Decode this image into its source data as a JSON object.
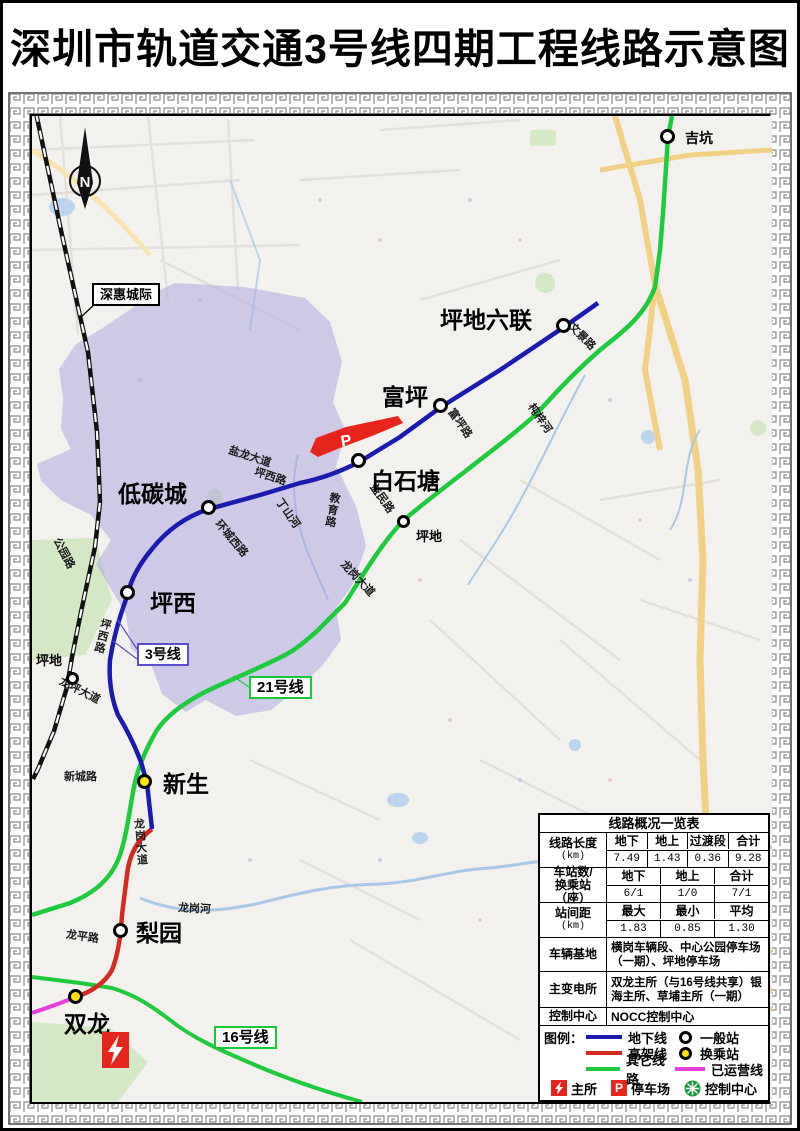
{
  "title": "深圳市轨道交通3号线四期工程线路示意图",
  "compass_label": "N",
  "map": {
    "stations": [
      {
        "name": "吉坑",
        "type": "normal"
      },
      {
        "name": "坪地六联",
        "type": "normal"
      },
      {
        "name": "富坪",
        "type": "normal"
      },
      {
        "name": "白石塘",
        "type": "normal"
      },
      {
        "name": "低碳城",
        "type": "normal"
      },
      {
        "name": "坪西",
        "type": "normal"
      },
      {
        "name": "新生",
        "type": "transfer"
      },
      {
        "name": "梨园",
        "type": "normal"
      },
      {
        "name": "双龙",
        "type": "transfer"
      },
      {
        "name": "坪地",
        "type": "railway"
      },
      {
        "name": "坪地",
        "type": "other-line"
      }
    ],
    "callouts": {
      "shenhui": "深惠城际",
      "line3": "3号线",
      "line21": "21号线",
      "line16": "16号线"
    },
    "roads": [
      "文景路",
      "富坪路",
      "杶梓河",
      "益民路",
      "教育路",
      "丁山河",
      "环城西路",
      "坪西路",
      "盐龙大道",
      "公园路",
      "坪西路",
      "龙坪大道",
      "新城路",
      "龙岗大道",
      "龙岗大道",
      "龙平路",
      "龙岗河"
    ],
    "parking_label": "P"
  },
  "table": {
    "title": "线路概况一览表",
    "length": {
      "label": "线路长度",
      "unit": "(km)",
      "headers": [
        "地下",
        "地上",
        "过渡段",
        "合计"
      ],
      "values": [
        "7.49",
        "1.43",
        "0.36",
        "9.28"
      ]
    },
    "stations": {
      "label": "车站数/",
      "label2": "换乘站（座）",
      "headers": [
        "地下",
        "地上",
        "合计"
      ],
      "values": [
        "6/1",
        "1/0",
        "7/1"
      ]
    },
    "spacing": {
      "label": "站间距",
      "unit": "(km)",
      "headers": [
        "最大",
        "最小",
        "平均"
      ],
      "values": [
        "1.83",
        "0.85",
        "1.30"
      ]
    },
    "depot": {
      "label": "车辆基地",
      "value": "横岗车辆段、中心公园停车场（一期）、坪地停车场"
    },
    "substation": {
      "label": "主变电所",
      "value": "双龙主所（与16号线共享）银海主所、草埔主所（一期）"
    },
    "control": {
      "label": "控制中心",
      "value": "NOCC控制中心"
    }
  },
  "legend": {
    "label": "图例：",
    "underground": "地下线",
    "elevated": "高架线",
    "other": "其它线路",
    "normal_station": "一般站",
    "transfer_station": "换乘站",
    "operating": "已运营线",
    "substation": "主所",
    "parking": "停车场",
    "control_center": "控制中心"
  },
  "colors": {
    "underground": "#1b1bb0",
    "elevated": "#d42a22",
    "other": "#1ecb3c",
    "operating": "#e83be0",
    "transfer_fill": "#ffe400",
    "region": "#a9a2e2"
  }
}
